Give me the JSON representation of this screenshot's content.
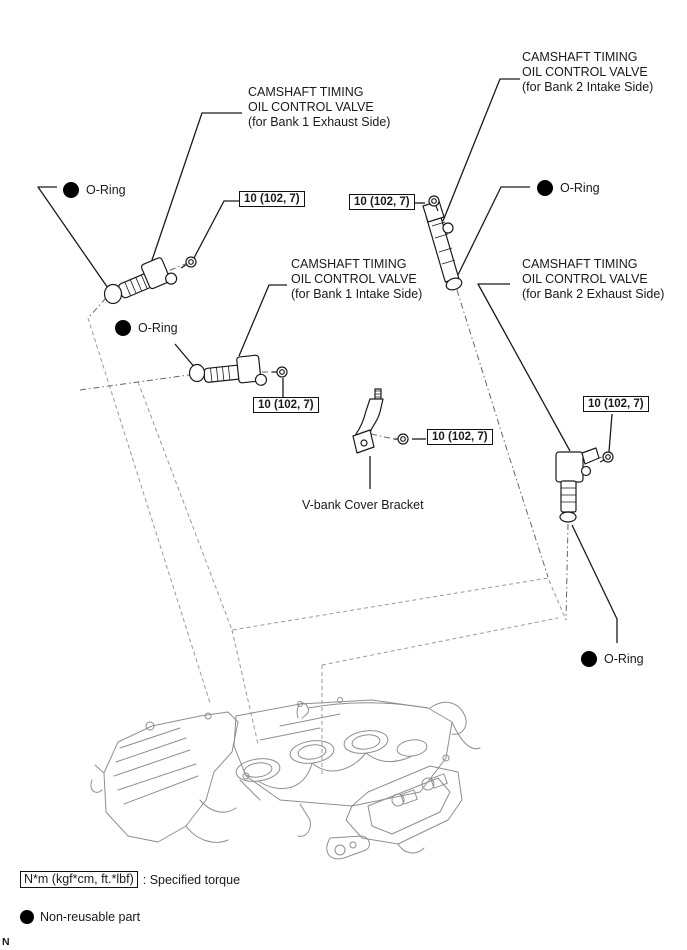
{
  "callouts": {
    "b1_exhaust": {
      "line1": "CAMSHAFT TIMING",
      "line2": "OIL CONTROL VALVE",
      "line3": "(for Bank 1 Exhaust Side)"
    },
    "b2_intake": {
      "line1": "CAMSHAFT TIMING",
      "line2": "OIL CONTROL VALVE",
      "line3": "(for Bank 2 Intake Side)"
    },
    "b1_intake": {
      "line1": "CAMSHAFT TIMING",
      "line2": "OIL CONTROL VALVE",
      "line3": "(for Bank 1 Intake Side)"
    },
    "b2_exhaust": {
      "line1": "CAMSHAFT TIMING",
      "line2": "OIL CONTROL VALVE",
      "line3": "(for Bank 2 Exhaust Side)"
    }
  },
  "oring_label": "O-Ring",
  "torque_value": "10 (102, 7)",
  "bracket_label": "V-bank Cover Bracket",
  "legend": {
    "torque_unit_box": "N*m (kgf*cm, ft.*lbf)",
    "torque_caption": ": Specified torque",
    "nonreusable": "Non-reusable part"
  },
  "page_marker": "N",
  "colors": {
    "ink": "#1a1a1a",
    "engine_line": "#8f8f8f",
    "construction_line": "#999999",
    "axis_line": "#666666",
    "background": "#ffffff"
  }
}
